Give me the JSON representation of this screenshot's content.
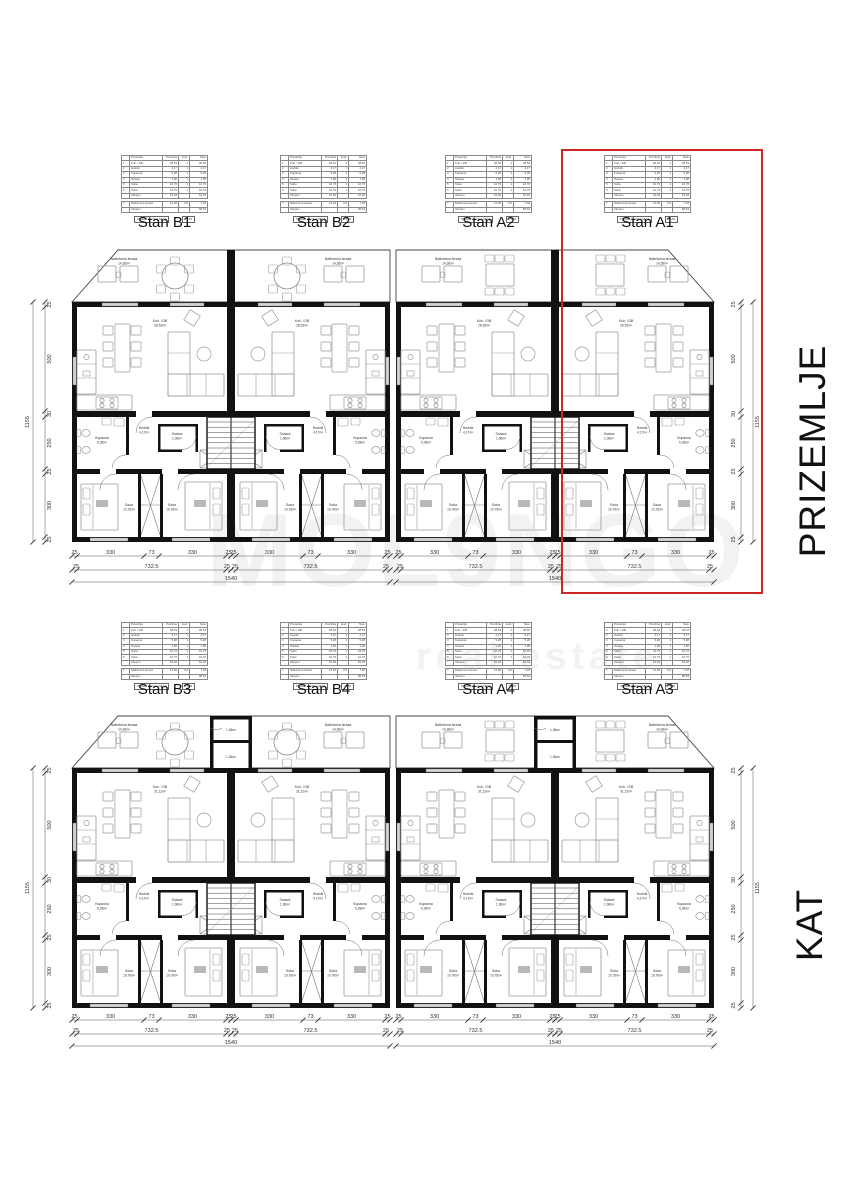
{
  "watermark": {
    "line1": "MOL9NGO",
    "line2": "real estate"
  },
  "floors": [
    {
      "title": "PRIZEMLJE",
      "units": [
        "Stan B1",
        "Stan B2",
        "Stan A2",
        "Stan A1"
      ],
      "areas": {
        "terrace": "14,36m²",
        "living": "28,53m²",
        "hall": "4,17m²",
        "bath": "5,28m²",
        "storage": "1,96m²",
        "bedroom": "10,76m²",
        "bedroom2": "10,76m²"
      }
    },
    {
      "title": "KAT",
      "units": [
        "Stan B3",
        "Stan B4",
        "Stan A4",
        "Stan A3"
      ],
      "areas": {
        "terrace": "14,36m²",
        "living": "31,12m²",
        "hall": "4,17m²",
        "bath": "5,28m²",
        "storage": "1,96m²",
        "bedroom": "10,76m²",
        "bedroom2": "10,76m²",
        "balcony": "1,36m²"
      }
    }
  ],
  "rooms": {
    "terrace": "Natkrivena terasa",
    "living": "Kuh. i DB",
    "hall": "Hodnik",
    "bath": "Kupaona",
    "storage": "Ostava",
    "bedroom": "Soba"
  },
  "dims": {
    "h_unit": [
      "25",
      "330",
      "73",
      "330",
      "25"
    ],
    "h_mid": [
      "25",
      "732.5",
      "25"
    ],
    "h_total": "1540",
    "v": [
      "25",
      "500",
      "30",
      "250",
      "25",
      "300",
      "25"
    ],
    "v_total": "1155"
  },
  "unit_table": {
    "header": [
      "",
      "Prostorija",
      "Površina",
      "koef.",
      "Neto"
    ],
    "rows": [
      [
        "1",
        "Kuh. i DB",
        "28,53",
        "1",
        "28,53"
      ],
      [
        "2",
        "Hodnik",
        "4,17",
        "1",
        "4,17"
      ],
      [
        "3",
        "Kupaona",
        "5,28",
        "1",
        "5,28"
      ],
      [
        "4",
        "Ostava",
        "1,96",
        "1",
        "1,96"
      ],
      [
        "5",
        "Soba",
        "10,76",
        "1",
        "10,76"
      ],
      [
        "6",
        "Soba",
        "10,76",
        "1",
        "10,76"
      ],
      [
        "",
        "Ukupno",
        "61,46",
        "",
        "61,46"
      ]
    ],
    "rows2": [
      [
        "7",
        "Natkrivena terasa",
        "14,36",
        "0,5",
        "7,18"
      ],
      [
        "",
        "Ukupno",
        "",
        "",
        "68,64"
      ]
    ],
    "strip_label": "STAMB. površina",
    "strip_val": "68,64",
    "strip_total": "75,82"
  },
  "highlight": {
    "label": "Stan A1",
    "color": "#cc2626"
  }
}
